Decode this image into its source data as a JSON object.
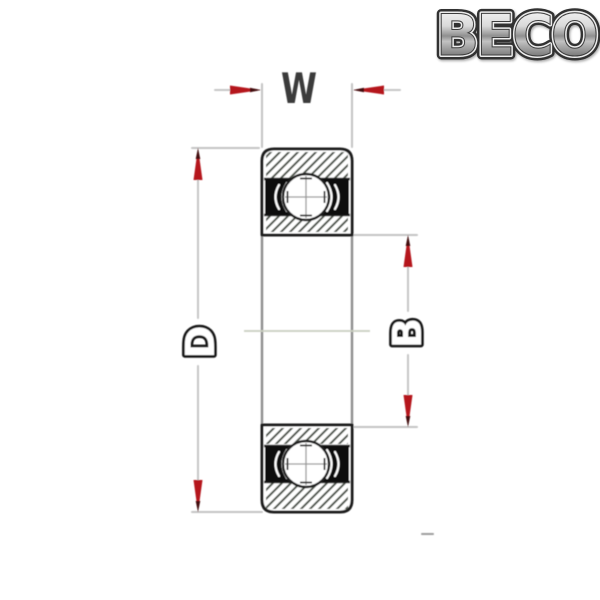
{
  "logo": {
    "text": "BECO"
  },
  "diagram": {
    "type": "sealed-deep-groove-ball-bearing-cross-section",
    "labels": {
      "width": "W",
      "outer_diameter": "D",
      "bore": "B"
    },
    "colors": {
      "arrow_red": "#b5151d",
      "arrow_tip_dark": "#42070a",
      "dimension_line": "#c6c6c6",
      "section_outline": "#1f1f1f",
      "hatch": "#50564e",
      "seal_black": "#101010",
      "label_dark": "#3a3a3a",
      "label_outline_fill": "#ffffff",
      "centerline": "#c9cec0",
      "background": "#ffffff",
      "logo_dark": "#333333",
      "logo_light": "#ededed"
    }
  }
}
